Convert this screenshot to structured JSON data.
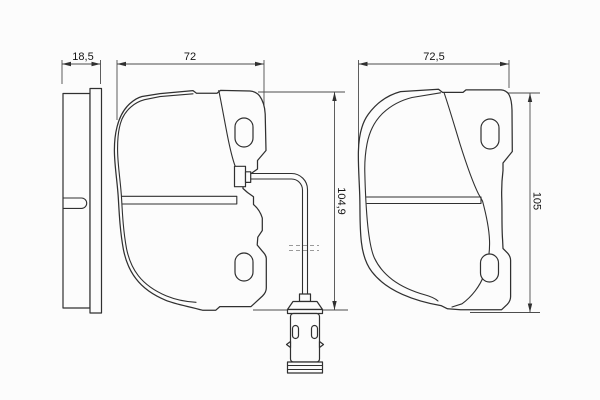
{
  "drawing": {
    "dimensions": {
      "side_view_thickness": "18,5",
      "sensor_pad_width": "72",
      "plain_pad_width": "72,5",
      "sensor_pad_height": "104,9",
      "plain_pad_height": "105"
    },
    "colors": {
      "background": "#fcfcfc",
      "part_line": "#303030",
      "dimension_line": "#4d4d4d",
      "break_line": "#9a9a9a"
    }
  }
}
